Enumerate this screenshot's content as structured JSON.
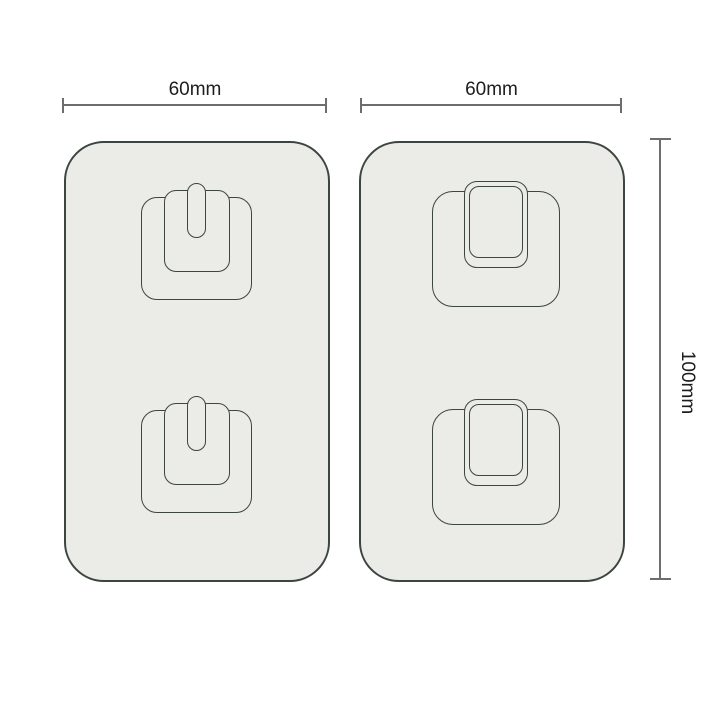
{
  "figure": {
    "left_pad": {
      "width_label": "60mm",
      "hook_count": 2,
      "hook_style": "prong-hook-front-view"
    },
    "right_pad": {
      "width_label": "60mm",
      "hook_count": 2,
      "hook_style": "tab-hook-front-view"
    },
    "height_label": "100mm"
  },
  "colors": {
    "background": "#ffffff",
    "pad_fill": "#ebebe8",
    "outline": "#3d453f",
    "dimension_line": "#6d6d6d",
    "text": "#1d1d1d"
  }
}
